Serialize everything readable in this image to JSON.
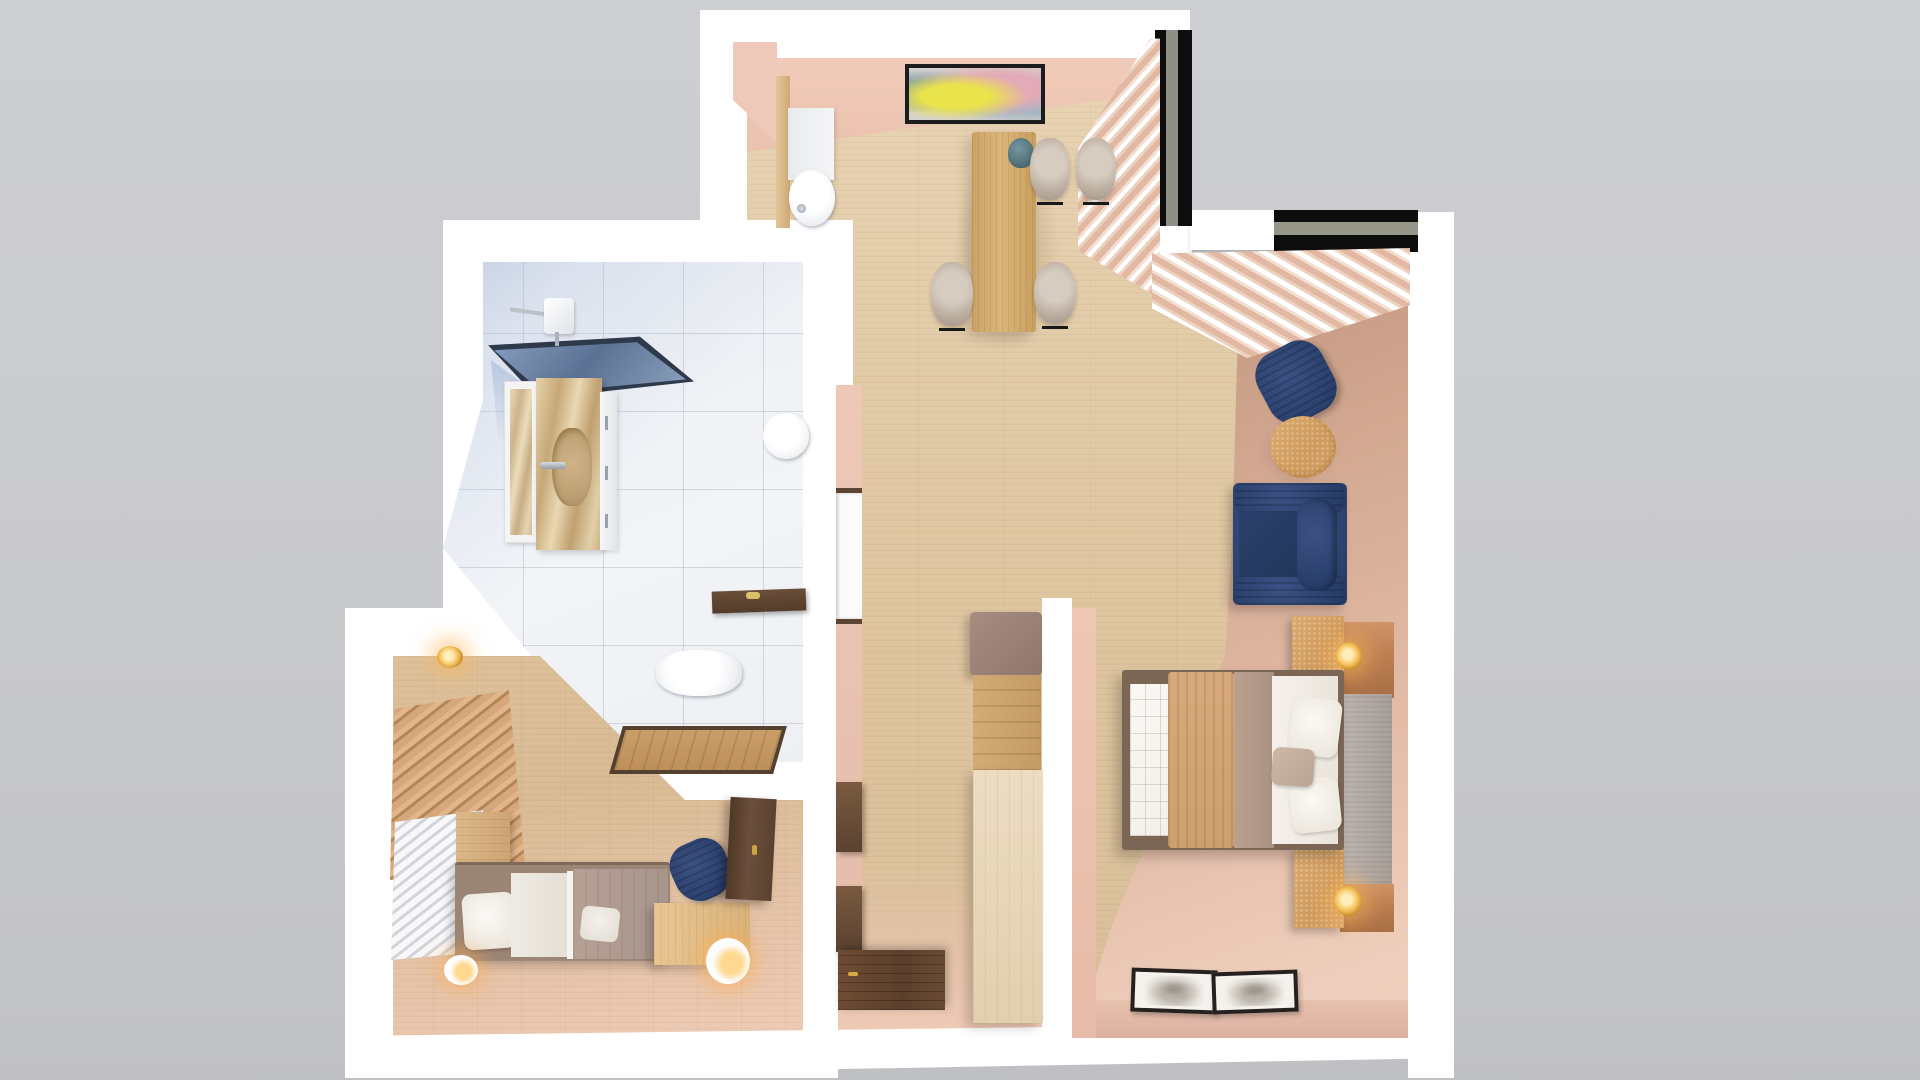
{
  "scene": {
    "title": "Apartment 3D floor plan render — top-down view",
    "style": "photorealistic architectural render, no visible text",
    "background_color": "#c9cacd",
    "wall_color": "#ffffff"
  },
  "palette": {
    "wood_floor": "#ddc6a2",
    "pink_wall": "#eec8b6",
    "mauve_floor": "#d9b2a2",
    "navy_fabric": "#2e4472",
    "cork_wood": "#d8a468",
    "copper_panel": "#bb8057",
    "shower_glass": "#8aa0bf",
    "marble_tile": "#eef0f4",
    "dark_walnut": "#5e4433",
    "brass_glow": "#f6c35e"
  },
  "rooms": [
    {
      "label": "Dining room",
      "items": [
        "abstract wall painting",
        "wooden dining table",
        "teal vase",
        "dining chair",
        "WC niche toilet",
        "WC cabinet"
      ]
    },
    {
      "label": "Corner windows",
      "items": [
        "black framed corner window",
        "sheer and blush curtains"
      ]
    },
    {
      "label": "Living nook",
      "items": [
        "navy armchair",
        "round cork coffee table",
        "navy loveseat sofa"
      ]
    },
    {
      "label": "Master bedroom",
      "items": [
        "double bed with quilted duvet",
        "camel throw blanket",
        "upholstered headboard",
        "copper wall panel",
        "cork nightstand",
        "brass sconce lamp",
        "framed prints on floor"
      ]
    },
    {
      "label": "Bathroom",
      "items": [
        "glass walk-in shower",
        "rain shower head",
        "onyx vanity with sink",
        "tall framed mirror",
        "drawer unit",
        "wall-hung toilet",
        "walnut bench",
        "parquet floor inset",
        "second wall-hung toilet"
      ]
    },
    {
      "label": "Hallway",
      "items": [
        "built-in column with seat cushion",
        "wooden storage column",
        "stone column base",
        "floating wall shelves",
        "shelf niche",
        "dark walnut entry door"
      ]
    },
    {
      "label": "Kids bedroom",
      "items": [
        "slatted wardrobe front",
        "white louver wardrobe front",
        "bedside cabinet",
        "single bed",
        "desk",
        "table lamp",
        "navy desk chair",
        "walnut wardrobe",
        "glowing floor lamp",
        "wall sconce"
      ]
    }
  ]
}
